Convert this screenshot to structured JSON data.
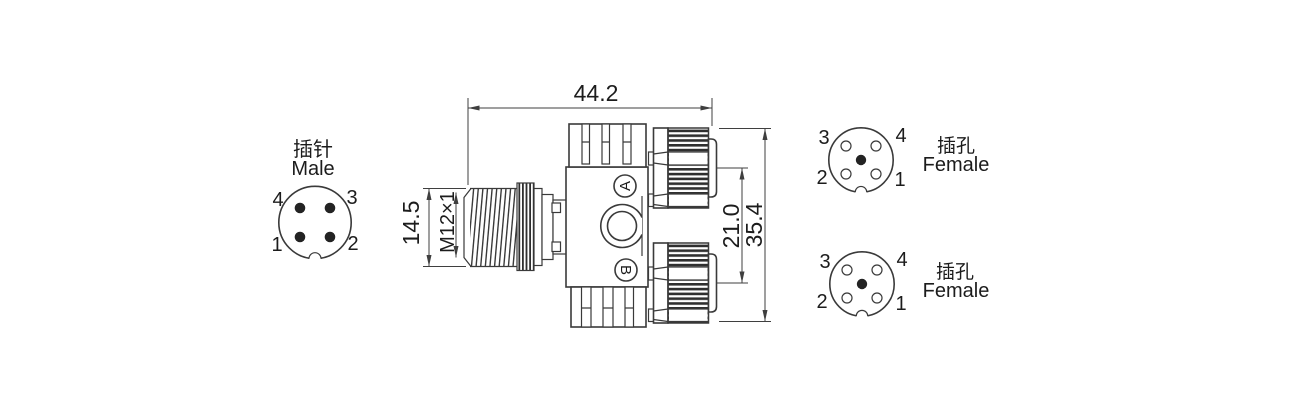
{
  "colors": {
    "line": "#3a3a3a",
    "dimension": "#3f3f3f",
    "text": "#1c1c1c",
    "background": "#ffffff"
  },
  "male_connector": {
    "label_zh": "插针",
    "label_en": "Male",
    "pins": {
      "top_left": "4",
      "top_right": "3",
      "bottom_left": "1",
      "bottom_right": "2"
    }
  },
  "female_top": {
    "label_zh": "插孔",
    "label_en": "Female",
    "pins": {
      "top_left": "3",
      "top_right": "4",
      "bottom_left": "2",
      "bottom_right": "1"
    }
  },
  "female_bottom": {
    "label_zh": "插孔",
    "label_en": "Female",
    "pins": {
      "top_left": "3",
      "top_right": "4",
      "bottom_left": "2",
      "bottom_right": "1"
    }
  },
  "dimensions": {
    "overall_length": "44.2",
    "male_body_diameter": "14.5",
    "thread_spec": "M12×1",
    "port_center_spacing": "21.0",
    "overall_height": "35.4"
  },
  "ports": {
    "a": "A",
    "b": "B"
  }
}
